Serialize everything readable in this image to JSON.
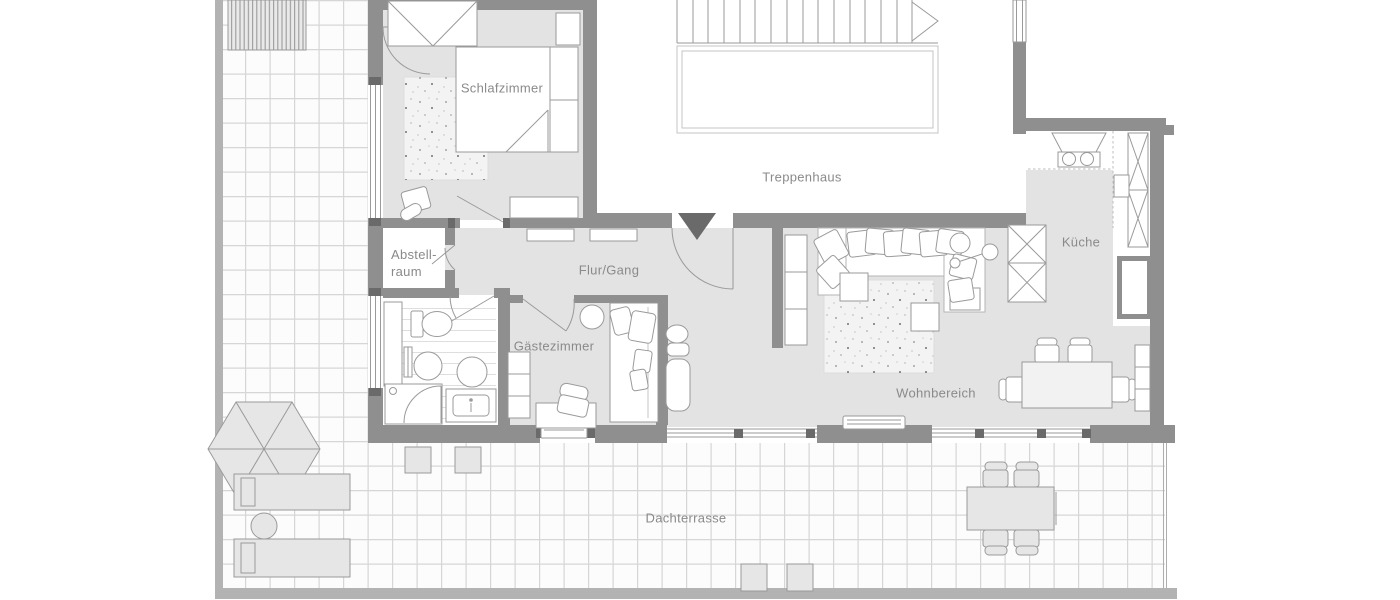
{
  "plan": {
    "rooms": {
      "schlafzimmer": {
        "label": "Schlafzimmer"
      },
      "treppenhaus": {
        "label": "Treppenhaus"
      },
      "abstellraum": {
        "label_line1": "Abstell-",
        "label_line2": "raum"
      },
      "flur": {
        "label": "Flur/Gang"
      },
      "gaestezimmer": {
        "label": "Gästezimmer"
      },
      "kueche": {
        "label": "Küche"
      },
      "wohnbereich": {
        "label": "Wohnbereich"
      },
      "dachterrasse": {
        "label": "Dachterrasse"
      }
    },
    "colors": {
      "wall": "#8f8f8f",
      "parapet": "#b3b3b3",
      "floor": "#e3e3e3",
      "outline": "#9a9a9a",
      "tile_grout": "#d6d6d6",
      "label_text": "#8a8a8a",
      "door_arrow": "#6a6a6a",
      "terrace_furniture": "#e6e6e6",
      "rug": "#f3f3f3"
    }
  }
}
